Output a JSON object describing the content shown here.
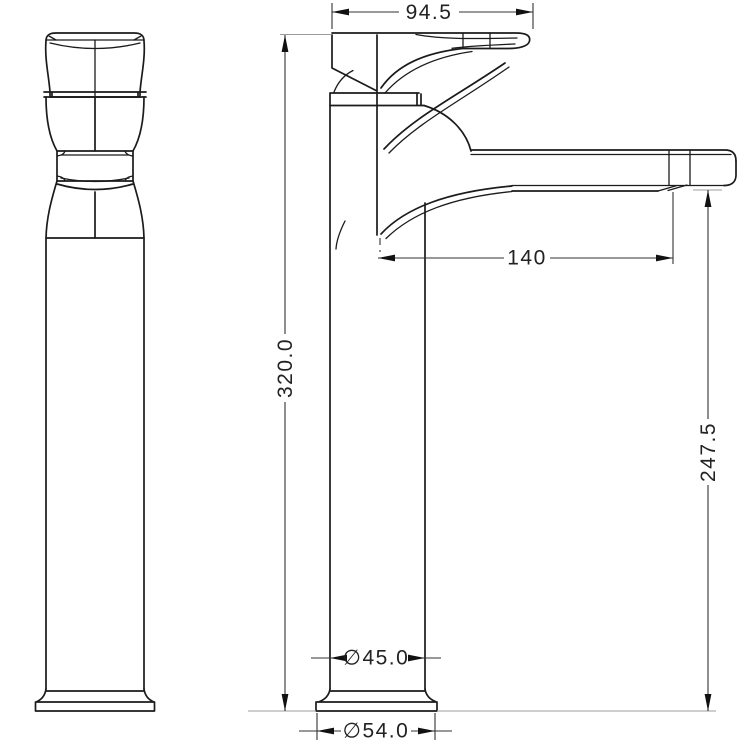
{
  "dims": {
    "handle_width": "94.5",
    "overall_height": "320.0",
    "spout_reach": "140",
    "spout_height": "247.5",
    "body_diameter": "∅45.0",
    "base_diameter": "∅54.0"
  },
  "colors": {
    "background": "#ffffff",
    "part_outline": "#1b1b1b",
    "dimension_lines": "#333333",
    "dimension_text": "#222222",
    "extension_lines": "#9c9c9c"
  }
}
